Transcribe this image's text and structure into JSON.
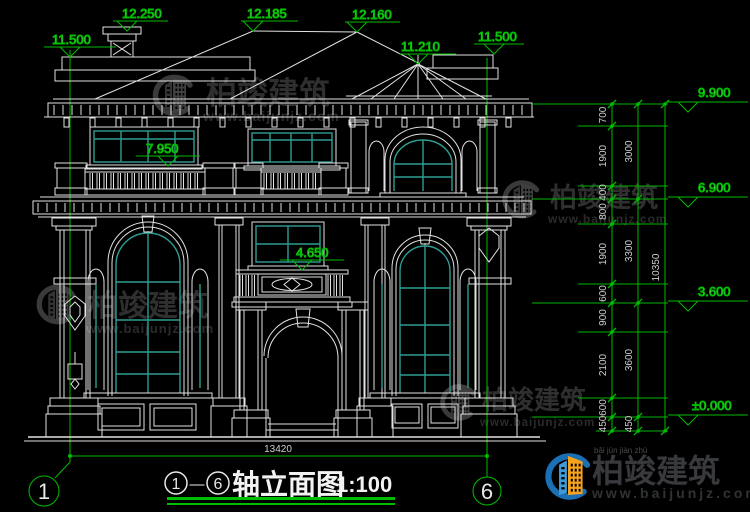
{
  "drawing": {
    "axis_start": "1",
    "axis_end": "6",
    "separator": "—",
    "title": "轴立面图",
    "scale": "1:100",
    "overall_width_dim": "13420"
  },
  "elevation_markers": {
    "left_parapet": "11.500",
    "chimney_top": "12.250",
    "ridge_left": "12.185",
    "ridge_main": "12.160",
    "turret_apex": "11.210",
    "right_parapet": "11.500",
    "terrace_rail": "7.950",
    "balcony_rail": "4.650"
  },
  "right_dimension_chain": {
    "level_markers": [
      "9.900",
      "6.900",
      "3.600",
      "±0.000"
    ],
    "segments_inner": [
      "700",
      "1900",
      "400",
      "800",
      "1900",
      "600",
      "900",
      "2100",
      "600",
      "450"
    ],
    "segments_floors": [
      "3000",
      "3300",
      "3600",
      "450"
    ],
    "segment_total": "10350"
  },
  "watermark": {
    "brand": "柏竣建筑",
    "url": "www.baijunjz.com",
    "pinyin": "bǎi jùn jiàn zhù"
  },
  "colors": {
    "background": "#000000",
    "line": "#e2e2e2",
    "glass_mullion": "#2f9d93",
    "dimension_green": "#00bd00",
    "dimension_text": "#d4d4d4",
    "watermark_gray": "#2f2f2f",
    "logo_blue": "#1b6fb5",
    "logo_light_blue": "#3f9bd8",
    "logo_orange": "#f7a11d"
  }
}
